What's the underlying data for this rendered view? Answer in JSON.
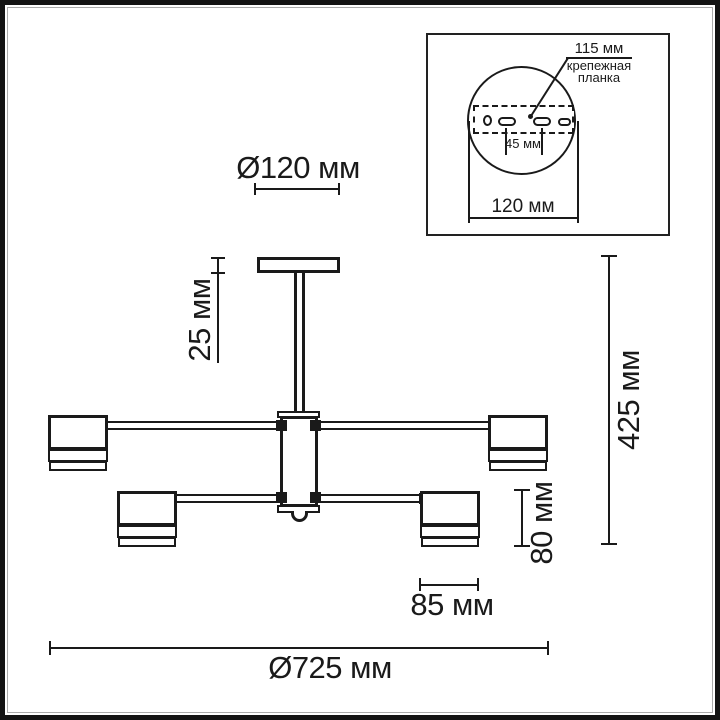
{
  "colors": {
    "line": "#1a1a1a",
    "background": "#ffffff",
    "frame": "#131313",
    "frame_inner_line": "#ababab"
  },
  "main_drawing": {
    "dim_canopy_diameter": "Ø120 мм",
    "dim_canopy_drop": "25 мм",
    "dim_total_height": "425 мм",
    "dim_shade_height": "80 мм",
    "dim_shade_width": "85 мм",
    "dim_fixture_diameter": "Ø725 мм"
  },
  "inset": {
    "dim_plate_width": "115 мм",
    "bracket_label_line1": "крепежная",
    "bracket_label_line2": "планка",
    "dim_slot_spacing": "45 мм",
    "dim_canopy_diameter": "120 мм"
  }
}
